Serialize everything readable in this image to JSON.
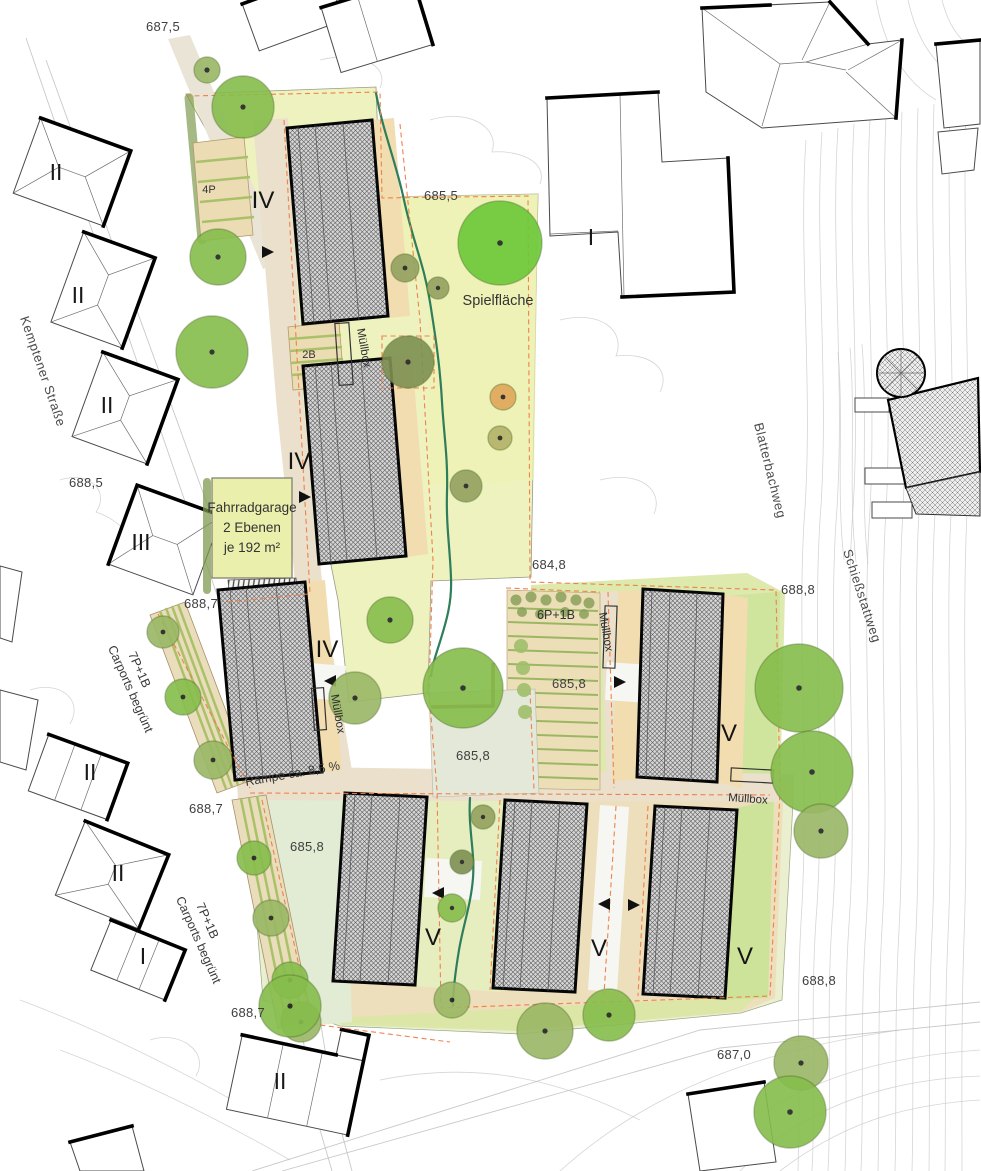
{
  "labels": {
    "elevations": [
      "687,5",
      "685,5",
      "688,5",
      "684,8",
      "688,7",
      "688,8",
      "685,8",
      "685,8",
      "688,7",
      "685,8",
      "688,8",
      "688,7",
      "687,0"
    ],
    "streets": [
      "Kemptener Straße",
      "Blatterbachweg",
      "Schießstattweg"
    ],
    "play_area": "Spielfläche",
    "ramp": "Rampe ca. 8,5 %",
    "bike_garage": [
      "Fahrradgarage",
      "2 Ebenen",
      "je 192 m²"
    ],
    "carports": [
      "7P+1B",
      "Carports begrünt"
    ],
    "parking": [
      "4P",
      "2B",
      "6P+1B"
    ],
    "waste_box": "Müllbox",
    "new_buildings": [
      "IV",
      "IV",
      "IV",
      "V",
      "V",
      "V",
      "V"
    ],
    "existing_buildings": [
      "II",
      "II",
      "II",
      "III",
      "I",
      "II",
      "II",
      "I",
      "II"
    ]
  },
  "colors": {
    "lawn": "#edf2bf",
    "lawn_pale": "#e2ebd3",
    "road": "#eae0cb",
    "paving_tan": "#f1ddb0",
    "building_hatch_bg": "#d6d6d6",
    "building_outline": "#060606",
    "boundary_dashed": "#ee7c44",
    "stream": "#2e7d5b",
    "tree_green": "#86bd4c",
    "contour": "#c7c7c7"
  }
}
